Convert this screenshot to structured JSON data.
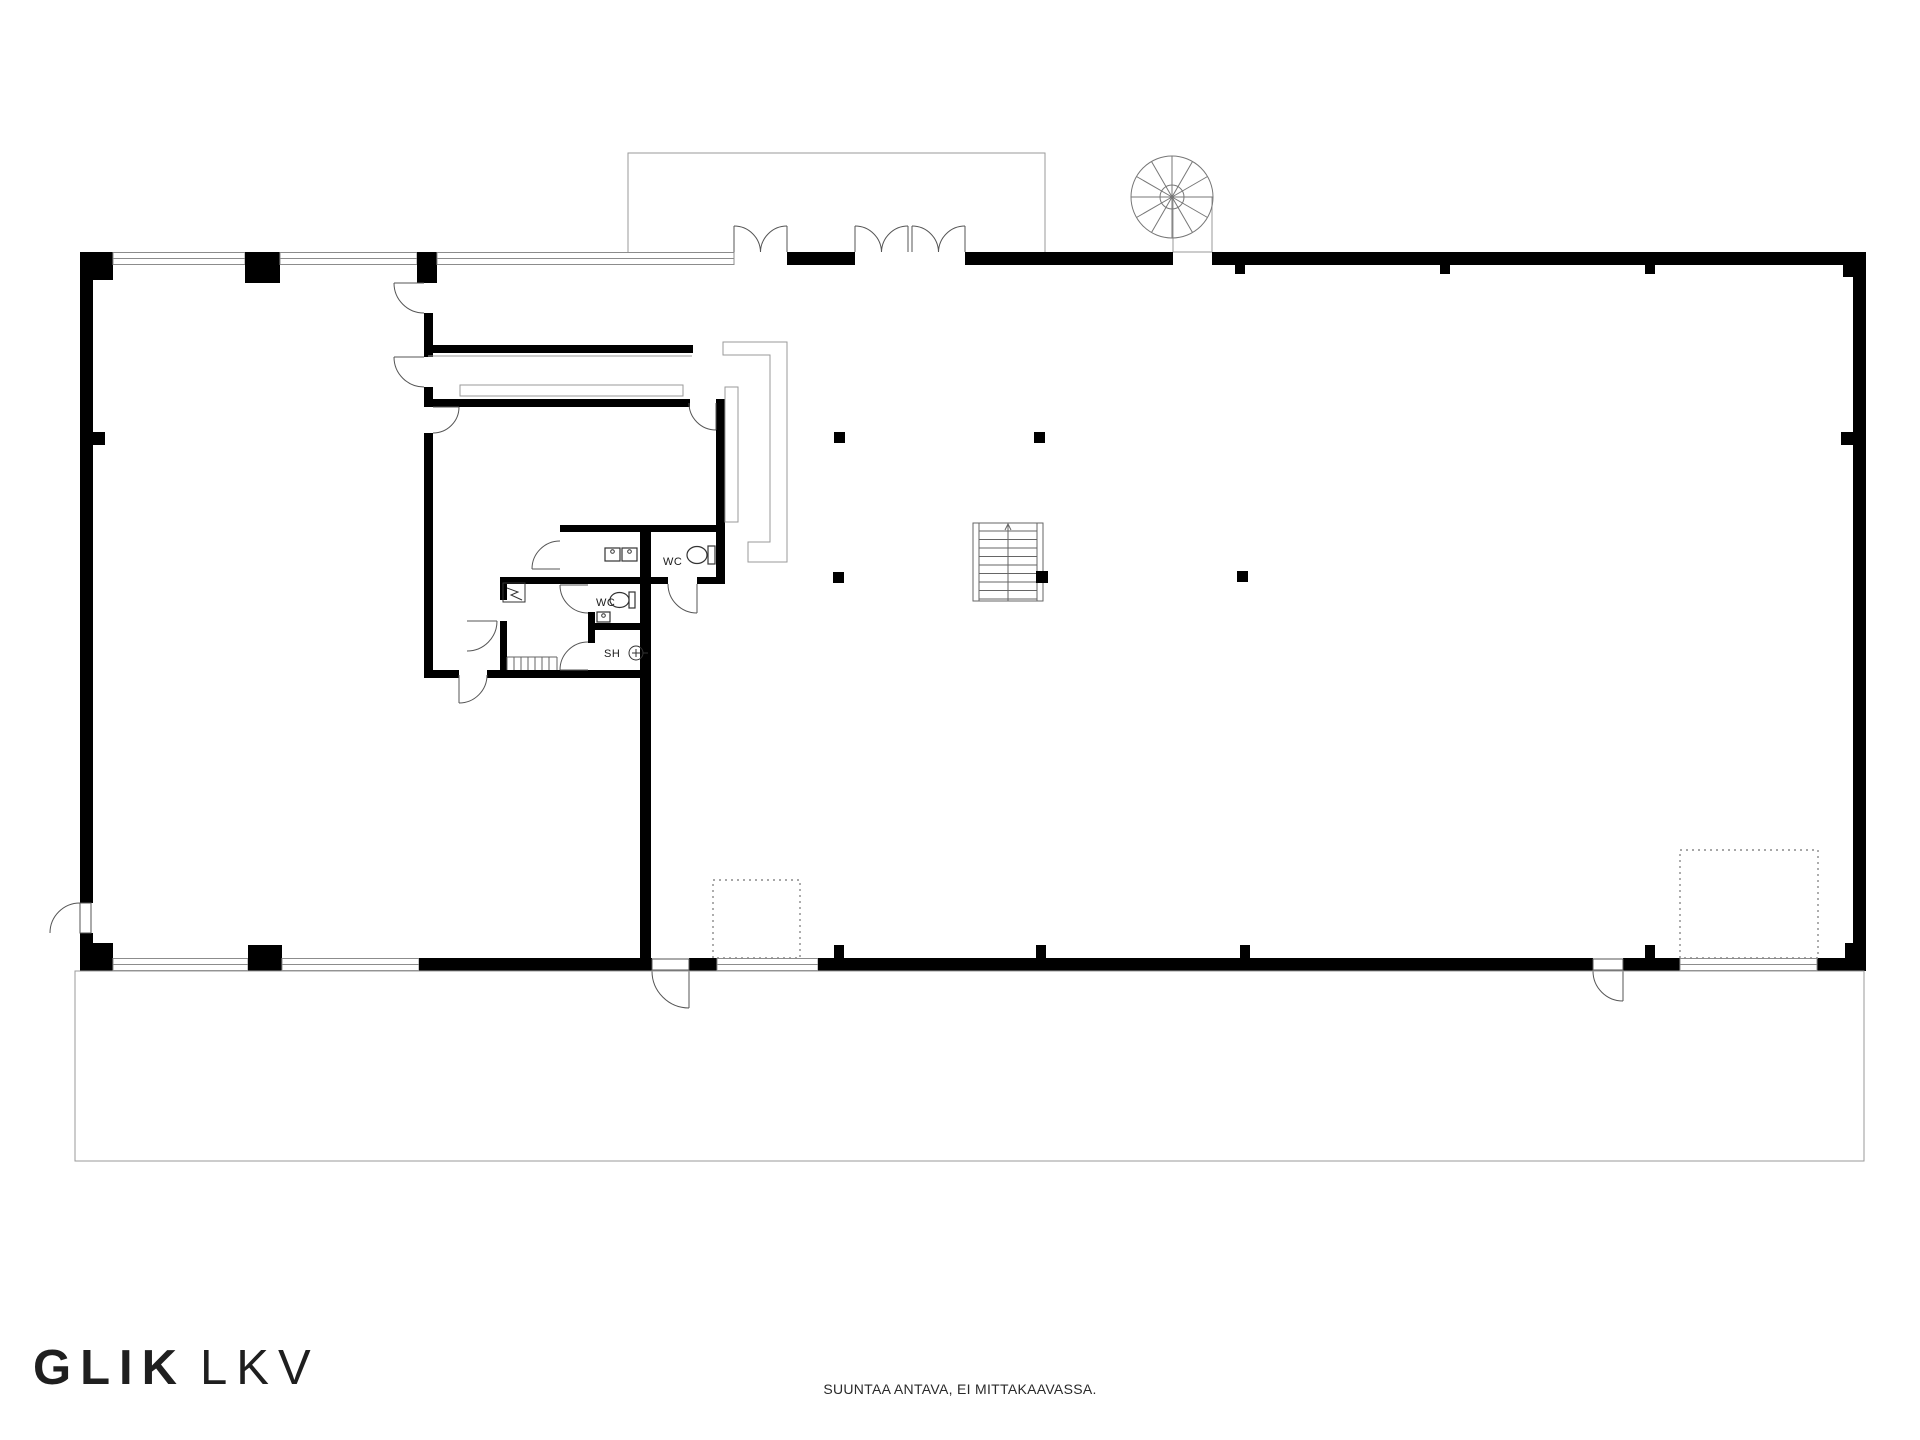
{
  "page": {
    "type": "floor-plan",
    "background": "#ffffff"
  },
  "branding": {
    "logo_primary": "GLIK",
    "logo_secondary": "LKV"
  },
  "footer": {
    "disclaimer": "SUUNTAA ANTAVA, EI MITTAKAAVASSA."
  },
  "floorplan": {
    "room_labels": [
      {
        "id": "wc-1",
        "text": "WC"
      },
      {
        "id": "wc-2",
        "text": "WC"
      },
      {
        "id": "shower",
        "text": "SH"
      }
    ],
    "colors": {
      "wall": "#000000",
      "thin_line": "#9a9a9a",
      "window_line": "#8c8c8c",
      "door_arc": "#555555",
      "label_text": "#1a1a1a"
    },
    "features": [
      "rectangular building envelope with window bands",
      "canopy outline over two double entrance doors (top)",
      "spiral staircase (top right)",
      "central straight staircase with direction arrow",
      "5 structural columns",
      "interior cluster: meeting rooms, 2 WC rooms, shower room",
      "electrical cabinet symbol and small service stairs",
      "3 exterior single doors (left, bottom centre, bottom right)",
      "2 dotted storage/reserved areas",
      "terrace / apron outline below building"
    ]
  }
}
